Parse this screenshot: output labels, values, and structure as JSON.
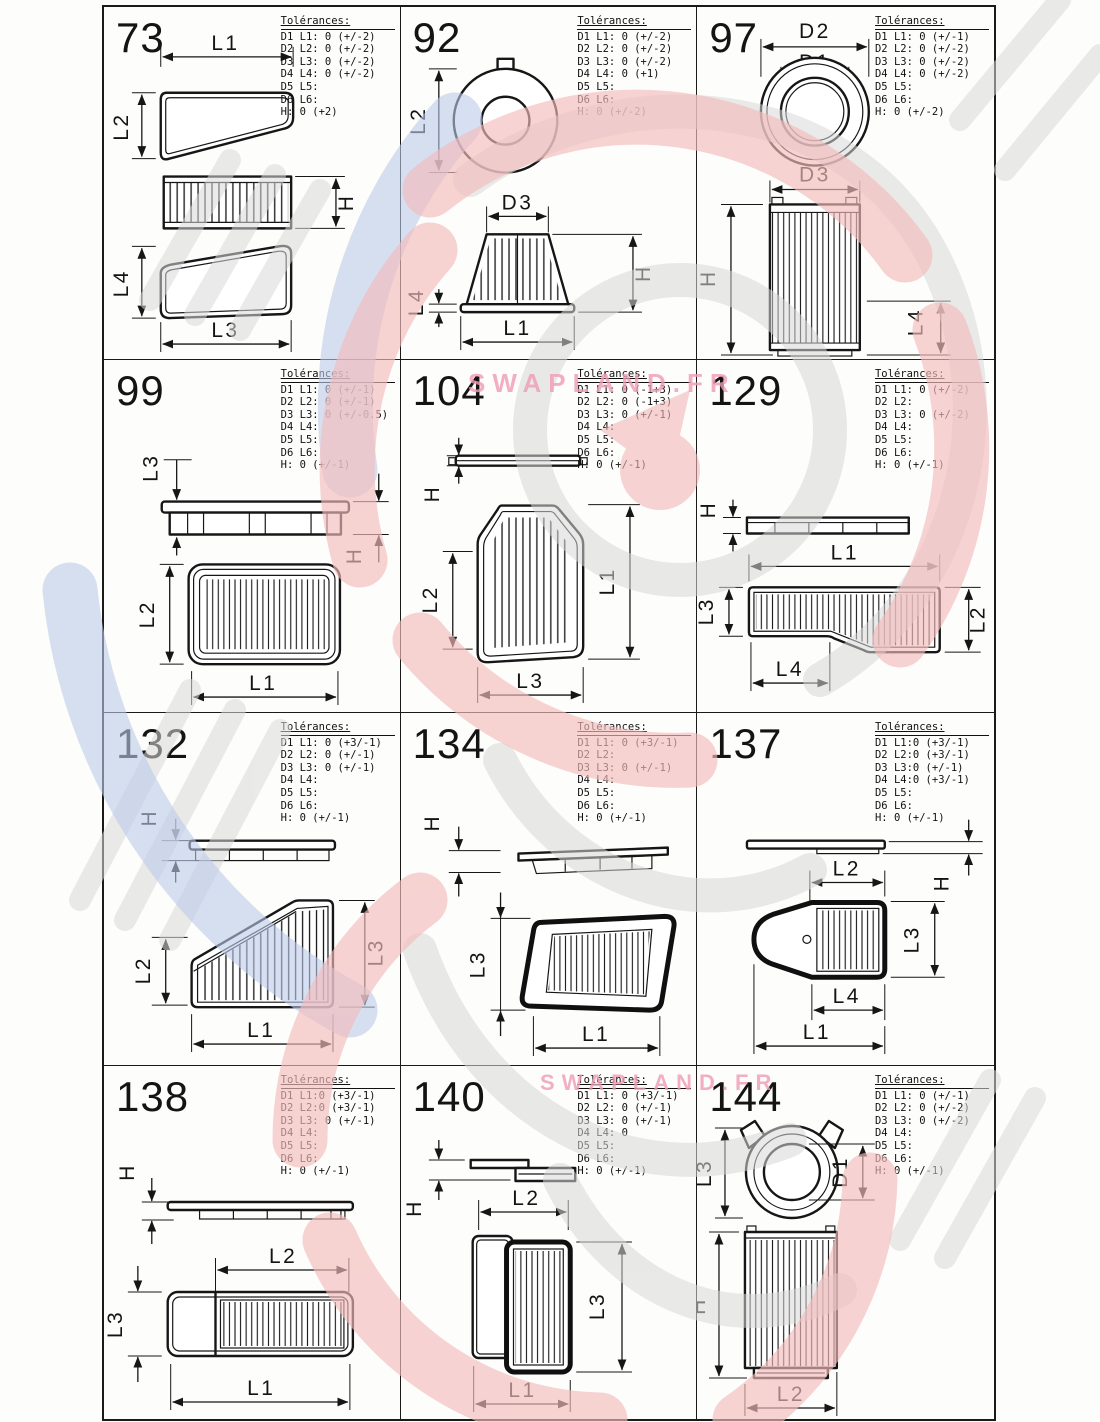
{
  "tolerances_heading": "Tolérances:",
  "watermark": {
    "brand": "SWAPLAND.FR",
    "accent_red": "#f3bcbc",
    "accent_blue": "#bdcbe9",
    "accent_gray": "#d8d8d8",
    "brand_pink": "#f19cb4"
  },
  "cells": [
    {
      "num": "73",
      "tol": [
        "D1 L1: 0 (+/-2)",
        "D2 L2: 0 (+/-2)",
        "D3 L3: 0 (+/-2)",
        "D4 L4: 0 (+/-2)",
        "D5 L5:",
        "D6 L6:",
        "H: 0 (+2)"
      ],
      "labels": {
        "l1": "L1",
        "l2": "L2",
        "h": "H",
        "l4": "L4",
        "l3": "L3"
      }
    },
    {
      "num": "92",
      "tol": [
        "D1 L1: 0 (+/-2)",
        "D2 L2: 0 (+/-2)",
        "D3 L3: 0 (+/-2)",
        "D4 L4: 0 (+1)",
        "D5 L5:",
        "D6 L6:",
        "H: 0 (+/-2)"
      ],
      "labels": {
        "l2": "L2",
        "d3": "D3",
        "h": "H",
        "l4": "L4",
        "l1": "L1"
      }
    },
    {
      "num": "97",
      "tol": [
        "D1 L1: 0 (+/-1)",
        "D2 L2: 0 (+/-2)",
        "D3 L3: 0 (+/-2)",
        "D4 L4: 0 (+/-2)",
        "D5 L5:",
        "D6 L6:",
        "H: 0 (+/-2)"
      ],
      "labels": {
        "d2": "D2",
        "d1": "D1",
        "d3": "D3",
        "h": "H",
        "l4": "L4"
      }
    },
    {
      "num": "99",
      "tol": [
        "D1 L1: 0 (+/-1)",
        "D2 L2: 0 (+/-1)",
        "D3 L3: 0 (+/-0.5)",
        "D4 L4:",
        "D5 L5:",
        "D6 L6:",
        "H: 0 (+/-1)"
      ],
      "labels": {
        "l3": "L3",
        "h": "H",
        "l2": "L2",
        "l1": "L1"
      }
    },
    {
      "num": "104",
      "tol": [
        "D1 L1: 0 (-1+3)",
        "D2 L2: 0 (-1+3)",
        "D3 L3: 0 (+/-1)",
        "D4 L4:",
        "D5 L5:",
        "D6 L6:",
        "H: 0 (+/-1)"
      ],
      "labels": {
        "h": "H",
        "l2": "L2",
        "l1": "L1",
        "l3": "L3"
      }
    },
    {
      "num": "129",
      "tol": [
        "D1 L1: 0 (+/-2)",
        "D2 L2:",
        "D3 L3: 0 (+/-2)",
        "D4 L4:",
        "D5 L5:",
        "D6 L6:",
        "H: 0 (+/-1)"
      ],
      "labels": {
        "h": "H",
        "l1": "L1",
        "l3": "L3",
        "l2": "L2",
        "l4": "L4"
      }
    },
    {
      "num": "132",
      "tol": [
        "D1 L1: 0 (+3/-1)",
        "D2 L2: 0 (+/-1)",
        "D3 L3: 0 (+/-1)",
        "D4 L4:",
        "D5 L5:",
        "D6 L6:",
        "H: 0 (+/-1)"
      ],
      "labels": {
        "h": "H",
        "l2": "L2",
        "l3": "L3",
        "l1": "L1"
      }
    },
    {
      "num": "134",
      "tol": [
        "D1 L1: 0 (+3/-1)",
        "D2 L2:",
        "D3 L3: 0 (+/-1)",
        "D4 L4:",
        "D5 L5:",
        "D6 L6:",
        "H: 0 (+/-1)"
      ],
      "labels": {
        "h": "H",
        "l3": "L3",
        "l1": "L1"
      }
    },
    {
      "num": "137",
      "tol": [
        "D1 L1:0 (+3/-1)",
        "D2 L2:0 (+3/-1)",
        "D3 L3:0 (+/-1)",
        "D4 L4:0 (+3/-1)",
        "D5 L5:",
        "D6 L6:",
        "H: 0 (+/-1)"
      ],
      "labels": {
        "h": "H",
        "l2": "L2",
        "l3": "L3",
        "l4": "L4",
        "l1": "L1"
      }
    },
    {
      "num": "138",
      "tol": [
        "D1 L1:0 (+3/-1)",
        "D2 L2:0 (+3/-1)",
        "D3 L3: 0 (+/-1)",
        "D4 L4:",
        "D5 L5:",
        "D6 L6:",
        "H: 0 (+/-1)"
      ],
      "labels": {
        "h": "H",
        "l2": "L2",
        "l3": "L3",
        "l1": "L1"
      }
    },
    {
      "num": "140",
      "tol": [
        "D1 L1: 0 (+3/-1)",
        "D2 L2: 0 (+/-1)",
        "D3 L3: 0 (+/-1)",
        "D4 L4: 0",
        "D5 L5:",
        "D6 L6:",
        "H: 0 (+/-1)"
      ],
      "labels": {
        "h": "H",
        "l2": "L2",
        "l3": "L3",
        "l1": "L1"
      }
    },
    {
      "num": "144",
      "tol": [
        "D1 L1: 0 (+/-1)",
        "D2 L2: 0 (+/-2)",
        "D3 L3: 0 (+/-2)",
        "D4 L4:",
        "D5 L5:",
        "D6 L6:",
        "H: 0 (+/-1)"
      ],
      "labels": {
        "l3": "L3",
        "d1": "D1",
        "h": "H",
        "l2": "L2"
      }
    }
  ]
}
